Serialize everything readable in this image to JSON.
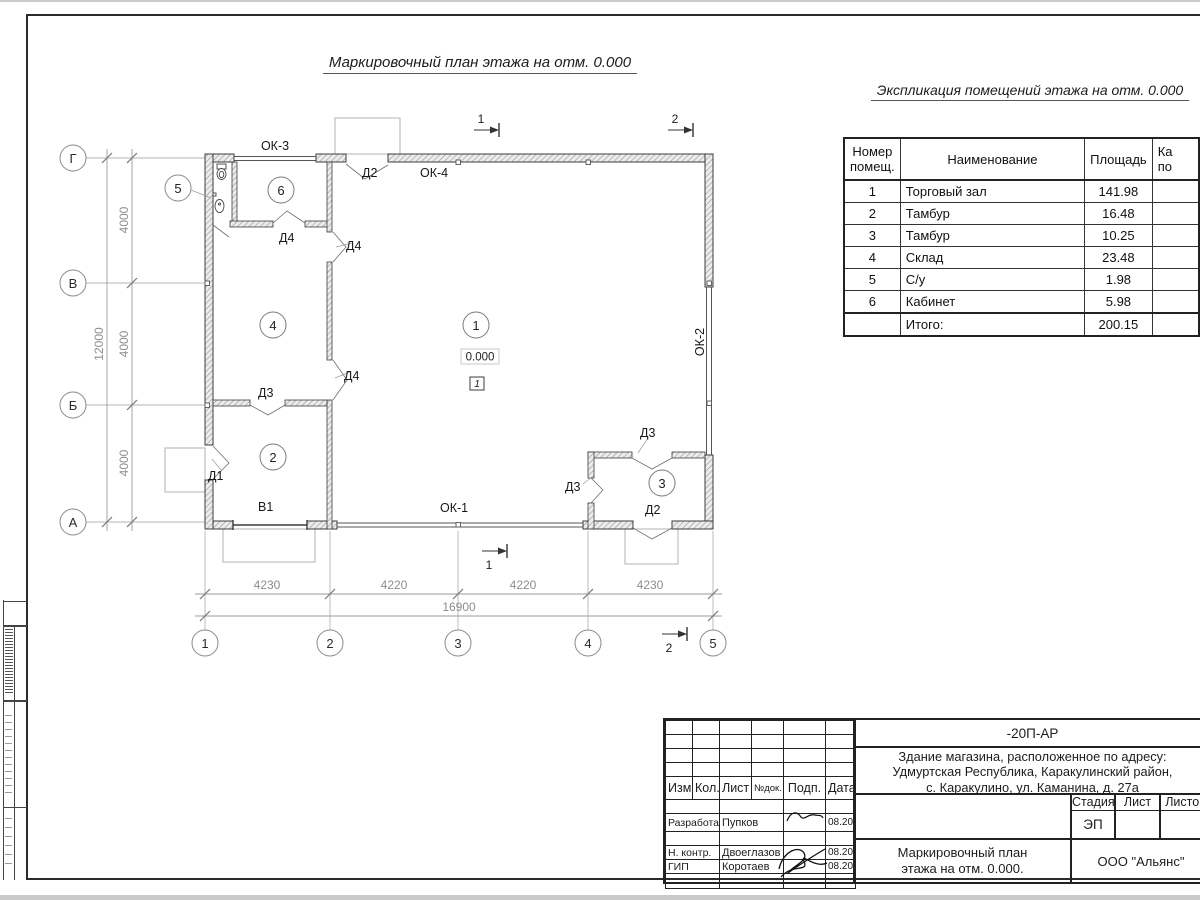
{
  "titles": {
    "plan": "Маркировочный план этажа на отм. 0.000",
    "schedule": "Экспликация помещений этажа на отм. 0.000"
  },
  "schedule": {
    "headers": {
      "num1": "Номер",
      "num2": "помещ.",
      "name": "Наименование",
      "area": "Площадь",
      "cat1": "Ка",
      "cat2": "по"
    },
    "rows": [
      {
        "num": "1",
        "name": "Торговый зал",
        "area": "141.98"
      },
      {
        "num": "2",
        "name": "Тамбур",
        "area": "16.48"
      },
      {
        "num": "3",
        "name": "Тамбур",
        "area": "10.25"
      },
      {
        "num": "4",
        "name": "Склад",
        "area": "23.48"
      },
      {
        "num": "5",
        "name": "С/у",
        "area": "1.98"
      },
      {
        "num": "6",
        "name": "Кабинет",
        "area": "5.98"
      }
    ],
    "total_label": "Итого:",
    "total_area": "200.15"
  },
  "plan": {
    "axes_rows": [
      "Г",
      "В",
      "Б",
      "А"
    ],
    "axes_cols": [
      "1",
      "2",
      "3",
      "4",
      "5"
    ],
    "dims": {
      "left": [
        "4000",
        "4000",
        "4000"
      ],
      "left_total": "12000",
      "bottom": [
        "4230",
        "4220",
        "4220",
        "4230"
      ],
      "bottom_total": "16900"
    },
    "windows": {
      "ok1": "ОК-1",
      "ok2": "ОК-2",
      "ok3": "ОК-3",
      "ok4": "ОК-4"
    },
    "doors": {
      "d1": "Д1",
      "d2": "Д2",
      "d3": "Д3",
      "d4": "Д4",
      "v1": "В1"
    },
    "rooms": [
      "1",
      "2",
      "3",
      "4",
      "5",
      "6"
    ],
    "elevation": "0.000",
    "floor_type": "1",
    "sections": {
      "s1": "1",
      "s2": "2"
    }
  },
  "title_block": {
    "doc_code": "-20П-АР",
    "address_lines": [
      "Здание магазина, расположенное по адресу:",
      "Удмуртская Республика, Каракулинский район,",
      "с. Каракулино, ул. Каманина, д. 27а"
    ],
    "columns": {
      "izm": "Изм.",
      "kol": "Кол.",
      "list": "Лист",
      "ndoc": "№док.",
      "podp": "Подп.",
      "data": "Дата"
    },
    "people": [
      {
        "role": "Разработал",
        "name": "Пупков",
        "date": "08.20"
      },
      {
        "role": "Н. контр.",
        "name": "Двоеглазов",
        "date": "08.20"
      },
      {
        "role": "ГИП",
        "name": "Коротаев",
        "date": "08.20"
      }
    ],
    "stage_label": "Стадия",
    "list_label": "Лист",
    "listov_label": "Листов",
    "stage_value": "ЭП",
    "drawing_name": [
      "Маркировочный план",
      "этажа на отм. 0.000."
    ],
    "company": "ООО \"Альянс\""
  }
}
